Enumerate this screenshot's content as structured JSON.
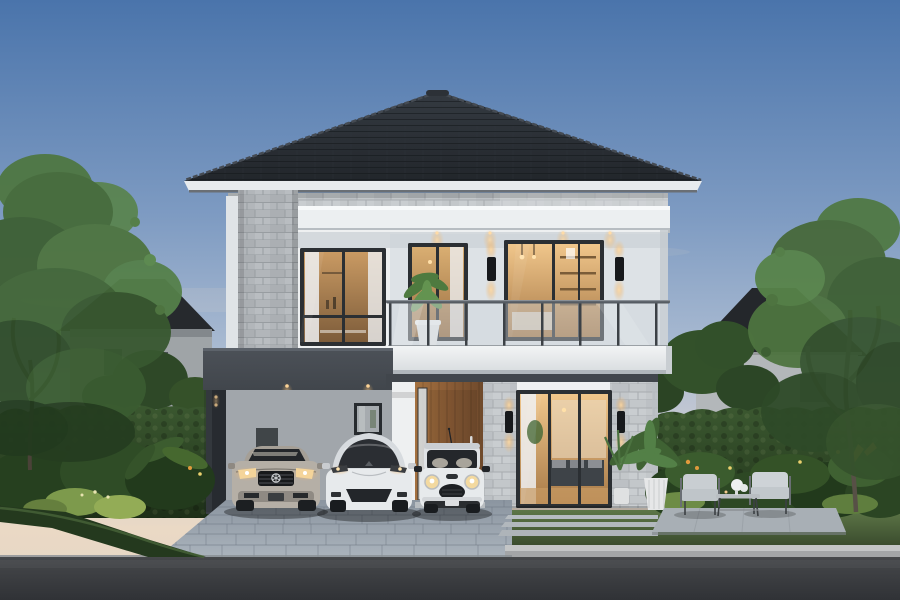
{
  "scene": {
    "description": "Dusk architectural rendering of a modern two-storey house with a dark hip roof, stone-clad accents, a glass-railing balcony with warm lit interiors, a carport and landscaped gardens; a silver coupe, a white SUV and a white mini hatchback are parked on a cobblestone driveway in front of an asphalt road, framed by hedges, large trees and neighbouring houses under a blue-to-peach evening sky.",
    "time_of_day": "dusk",
    "objects": [
      "evening-sky",
      "left-tree",
      "right-tree",
      "neighbor-house-left",
      "neighbor-house-right",
      "hedge-wall-left",
      "hedge-wall-right",
      "hip-roof",
      "stone-corner-column",
      "upper-floor-windows",
      "balcony-glass-railing",
      "balcony-plant",
      "wall-sconces",
      "recessed-downlights",
      "carport",
      "wooden-entrance-door",
      "living-room-glass-slider",
      "small-window",
      "corner-potted-plants",
      "silver-coupe-car",
      "white-suv-car",
      "white-mini-car",
      "cobblestone-driveway",
      "stepping-stones",
      "patio-seating-set",
      "flower-beds",
      "grass-verge",
      "street-curb",
      "asphalt-road"
    ]
  },
  "palette": {
    "sky_top": "#4a74ab",
    "sky_mid": "#a9bad1",
    "sky_horizon": "#ead9c5",
    "roof_dark": "#22262b",
    "roof_mid": "#343a41",
    "fascia_white": "#e8ebee",
    "stone_light": "#c3c7ca",
    "stone_shaded": "#b2b6ba",
    "wall_white": "#eef0f1",
    "wall_recess": "#dde2e6",
    "wall_shaded": "#c7ccd1",
    "band_dark": "#41464c",
    "frame_dark": "#2b2f33",
    "glow_warm": "#ffd9a0",
    "interior_bright": "#f0c68b",
    "interior_deep": "#9a6f42",
    "glass_cool": "#cdd5dc",
    "wood_door": "#8a5c36",
    "hedge_dark": "#24391e",
    "hedge_mid": "#3b5830",
    "leaf_bright": "#7d9a4c",
    "flower_orange": "#e09a3c",
    "grass_green": "#54713f",
    "driveway_pale": "#aab3bc",
    "driveway_deep": "#8b95a0",
    "road_asphalt": "#3b3d40",
    "curb_light": "#c3c5c6",
    "patio_gray": "#a8afb5",
    "car_silver": "#b5afa6",
    "car_white": "#e7eaec",
    "trunk_brown": "#575046"
  }
}
